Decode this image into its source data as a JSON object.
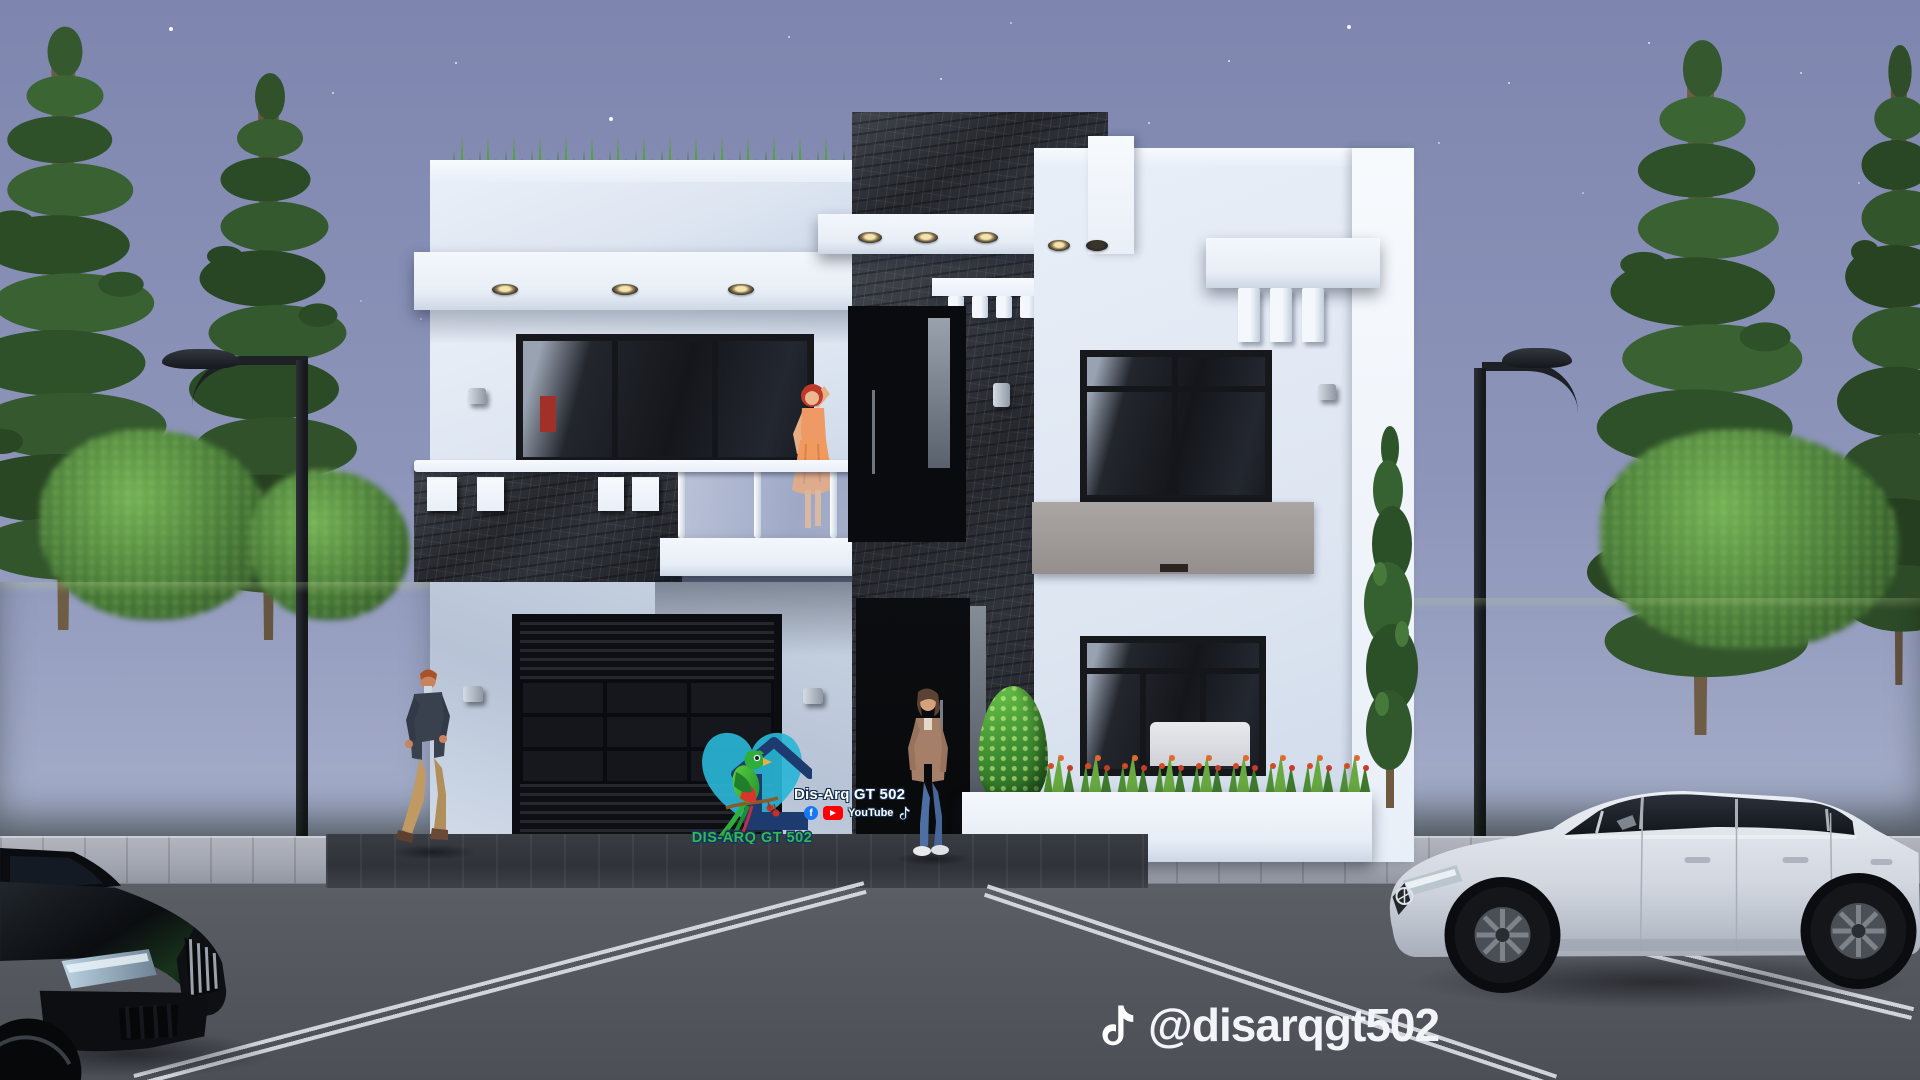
{
  "branding": {
    "logo_text_stylized": "DIS-ARQ GT 502",
    "logo_text_white": "Dis-Arq GT 502",
    "facebook_glyph": "f",
    "youtube_label": "YouTube",
    "colors": {
      "heart_teal": "#2ab5d6",
      "house_navy": "#1d3b6e",
      "text_green": "#35b84e",
      "facebook_blue": "#1877f2",
      "youtube_red": "#ff0000"
    }
  },
  "watermark": {
    "tiktok_handle": "@disarqgt502"
  },
  "palette": {
    "sky_top": "#7e86af",
    "sky_bottom": "#b3bcd2",
    "wall_white": "#e9eff8",
    "stone_dark": "#26282e",
    "hedge_green": "#44703a",
    "road_asphalt": "#55575f",
    "roof_grass": "#55a03e",
    "gray_panel": "#9e9997"
  }
}
